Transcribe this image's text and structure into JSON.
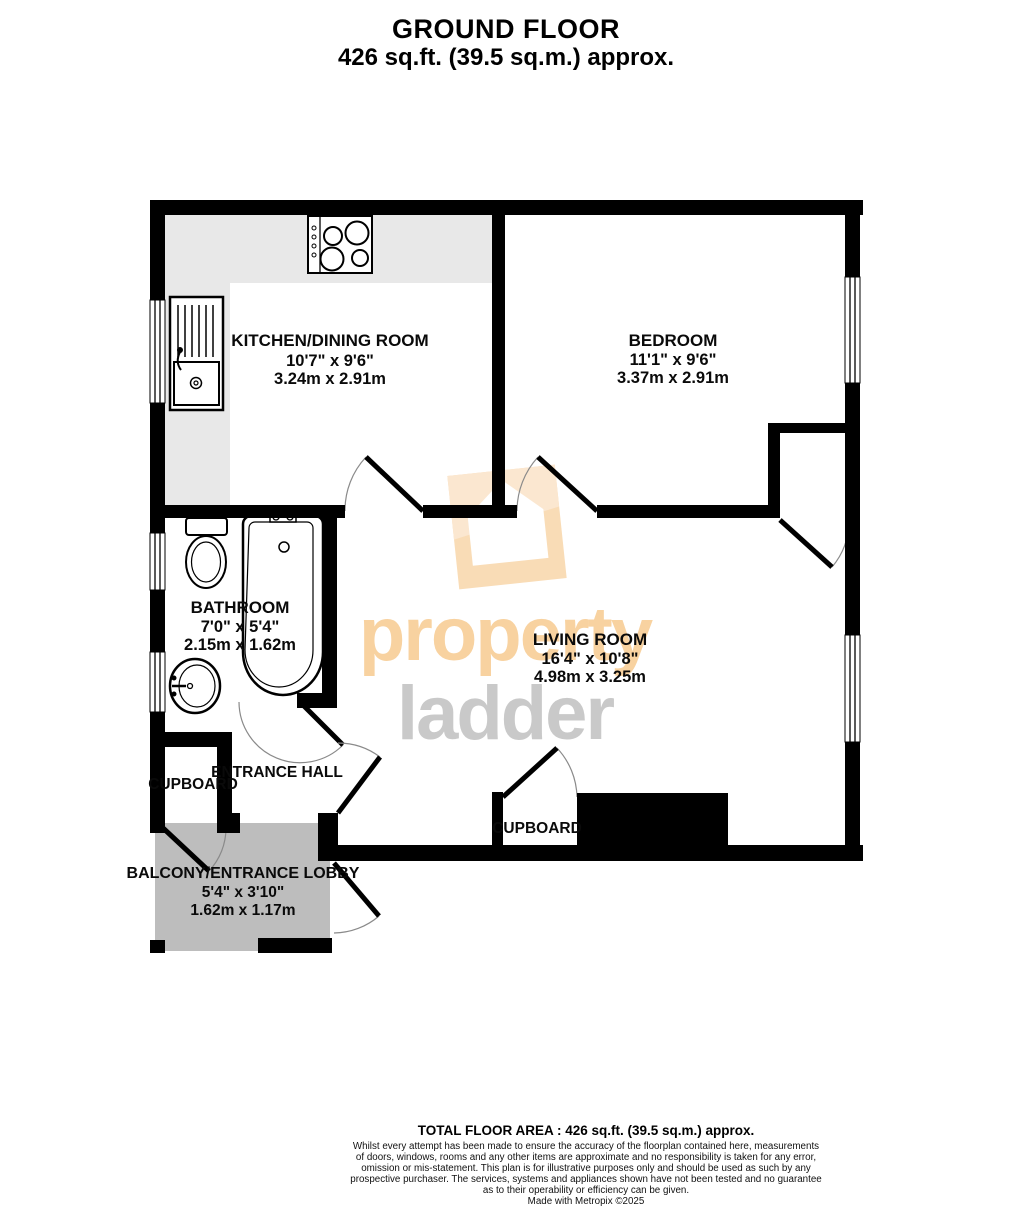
{
  "title": {
    "line1": "GROUND FLOOR",
    "line2": "426 sq.ft. (39.5 sq.m.) approx."
  },
  "rooms": {
    "kitchen": {
      "name": "KITCHEN/DINING ROOM",
      "imperial": "10'7\"  x 9'6\"",
      "metric": "3.24m  x 2.91m"
    },
    "bedroom": {
      "name": "BEDROOM",
      "imperial": "11'1\"  x 9'6\"",
      "metric": "3.37m  x 2.91m"
    },
    "bathroom": {
      "name": "BATHROOM",
      "imperial": "7'0\"  x 5'4\"",
      "metric": "2.15m  x 1.62m"
    },
    "living": {
      "name": "LIVING ROOM",
      "imperial": "16'4\"  x 10'8\"",
      "metric": "4.98m  x 3.25m"
    },
    "hall": {
      "name": "ENTRANCE HALL"
    },
    "cupboard_hall": {
      "name": "CUPBOARD"
    },
    "cupboard_living": {
      "name": "CUPBOARD"
    },
    "balcony": {
      "name": "BALCONY/ENTRANCE LOBBY",
      "imperial": "5'4\"  x 3'10\"",
      "metric": "1.62m  x 1.17m"
    }
  },
  "watermark": {
    "line1": "property",
    "line2": "ladder",
    "text_orange": "#f8d2a0",
    "text_gray": "#c9c9c9",
    "house_main": "#f9dcb6",
    "house_shade": "#fbe7d0"
  },
  "colors": {
    "wall": "#000000",
    "counter_gray": "#e8e8e8",
    "balcony_gray": "#bdbdbd"
  },
  "footer": {
    "total": "TOTAL FLOOR AREA : 426 sq.ft. (39.5 sq.m.) approx.",
    "disclaimer_lines": [
      "Whilst every attempt has been made to ensure the accuracy of the floorplan contained here, measurements",
      "of doors, windows, rooms and any other items are approximate and no responsibility is taken for any error,",
      "omission or mis-statement. This plan is for illustrative purposes only and should be used as such by any",
      "prospective purchaser. The services, systems and appliances shown have not been tested and no guarantee",
      "as to their operability or efficiency can be given."
    ],
    "credit": "Made with Metropix ©2025"
  }
}
